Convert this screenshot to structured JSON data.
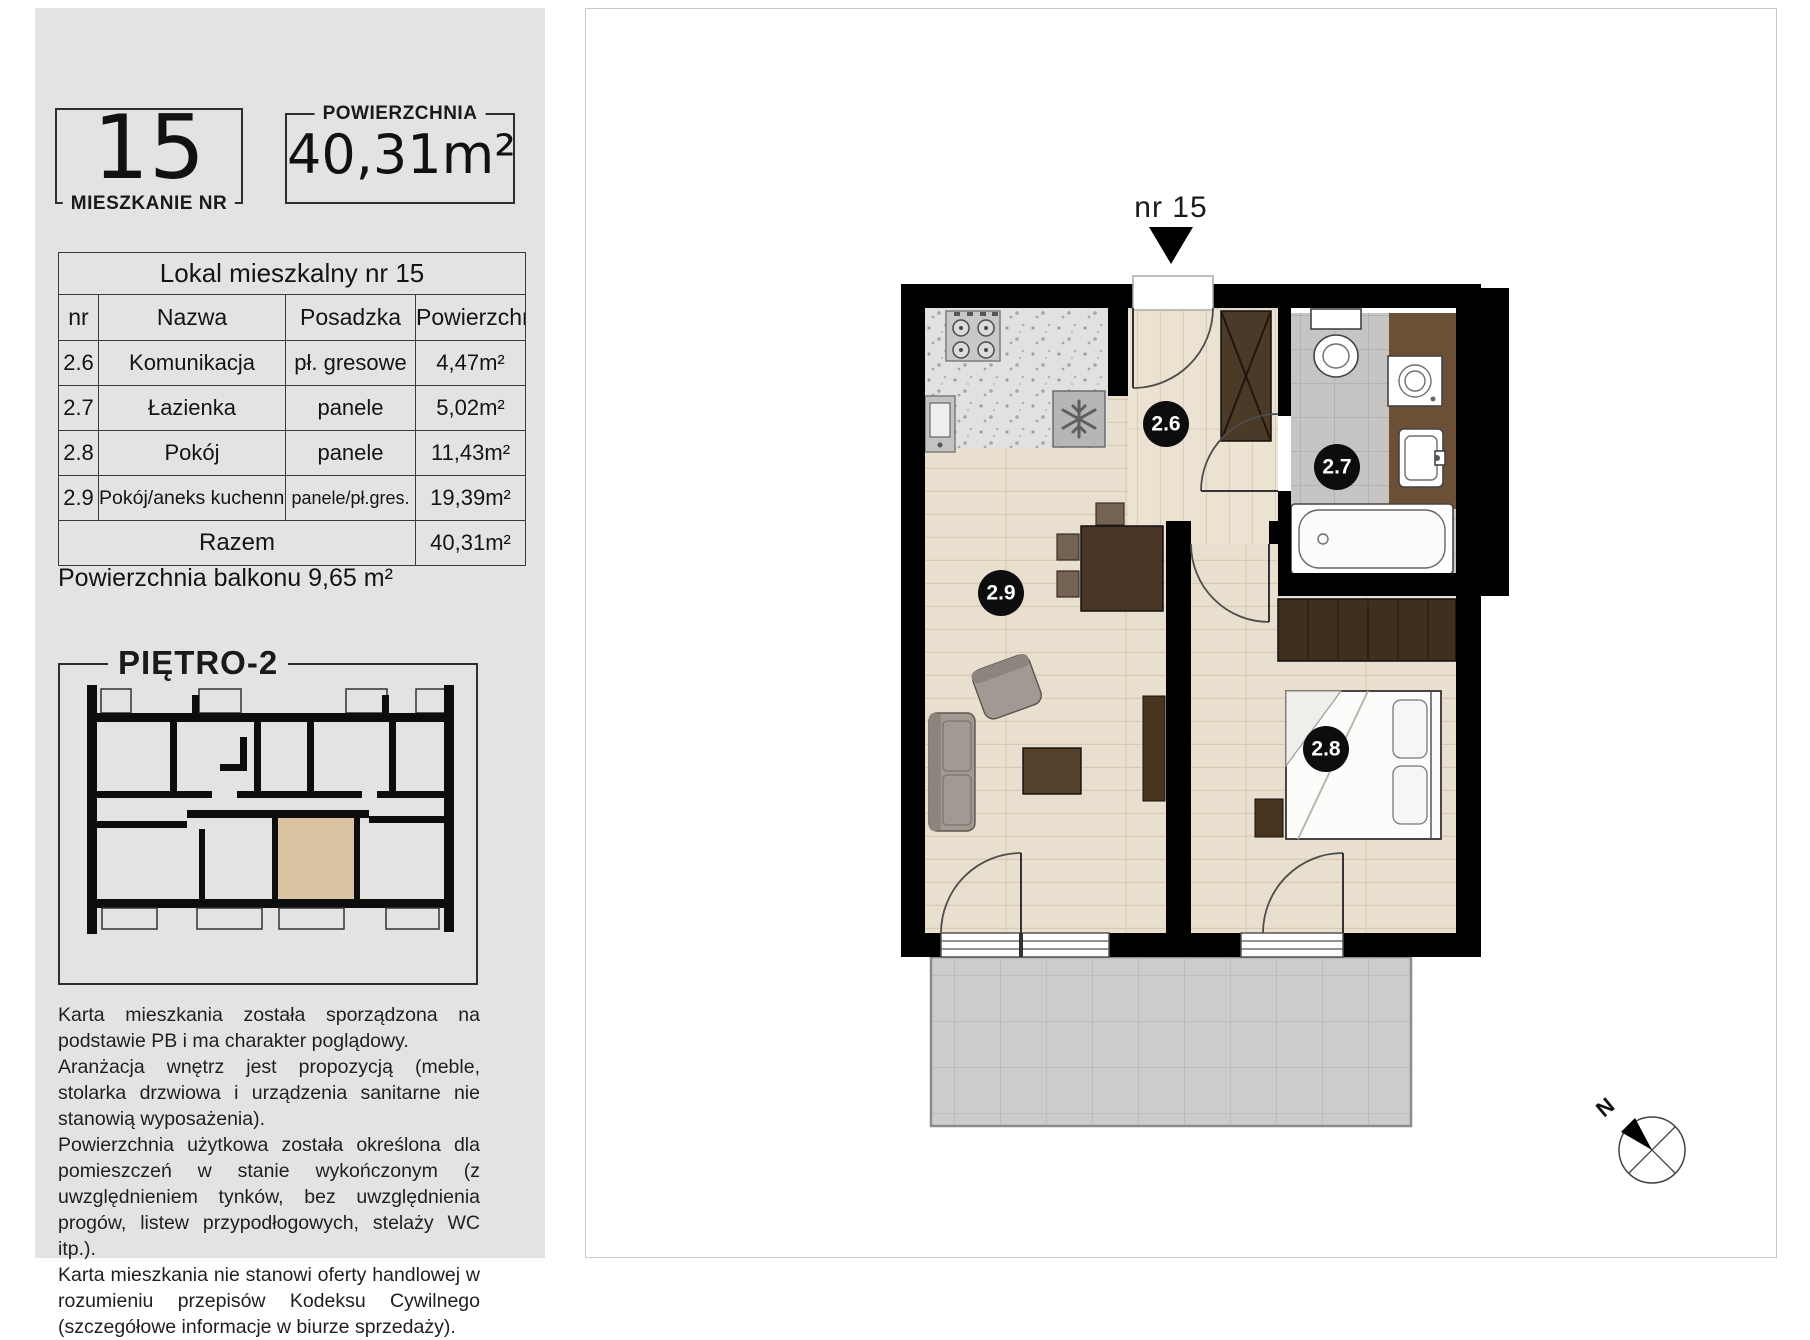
{
  "card": {
    "apartment_number": "15",
    "apartment_number_label": "MIESZKANIE NR",
    "area_label": "POWIERZCHNIA",
    "area_value": "40,31m²"
  },
  "rooms_table": {
    "title": "Lokal mieszkalny nr 15",
    "columns": [
      "nr",
      "Nazwa",
      "Posadzka",
      "Powierzchnia"
    ],
    "rows": [
      [
        "2.6",
        "Komunikacja",
        "pł. gresowe",
        "4,47m²"
      ],
      [
        "2.7",
        "Łazienka",
        "panele",
        "5,02m²"
      ],
      [
        "2.8",
        "Pokój",
        "panele",
        "11,43m²"
      ],
      [
        "2.9",
        "Pokój/aneks kuchenny",
        "panele/pł.gres.",
        "19,39m²"
      ]
    ],
    "total_label": "Razem",
    "total_value": "40,31m²"
  },
  "balcony_note": "Powierzchnia balkonu 9,65 m²",
  "floor_overview": {
    "title": "PIĘTRO-2",
    "highlight_color": "#d9c3a2"
  },
  "disclaimer": [
    "Karta mieszkania została sporządzona na podstawie PB i ma charakter poglądowy.",
    "Aranżacja wnętrz jest propozycją (meble, stolarka drzwiowa i urządzenia sanitarne nie stanowią wyposażenia).",
    "Powierzchnia użytkowa została określona dla pomieszczeń w stanie wykończonym (z uwzględnieniem tynków, bez uwzględnienia progów, listew przypodłogowych, stelaży WC itp.).",
    "Karta mieszkania nie stanowi oferty handlowej w rozumieniu przepisów Kodeksu Cywilnego (szczegółowe informacje w biurze sprzedaży)."
  ],
  "floor_plan": {
    "unit_pointer_label": "nr 15",
    "room_labels": {
      "hall": "2.6",
      "bathroom": "2.7",
      "bedroom": "2.8",
      "living": "2.9"
    },
    "compass_label": "N"
  }
}
